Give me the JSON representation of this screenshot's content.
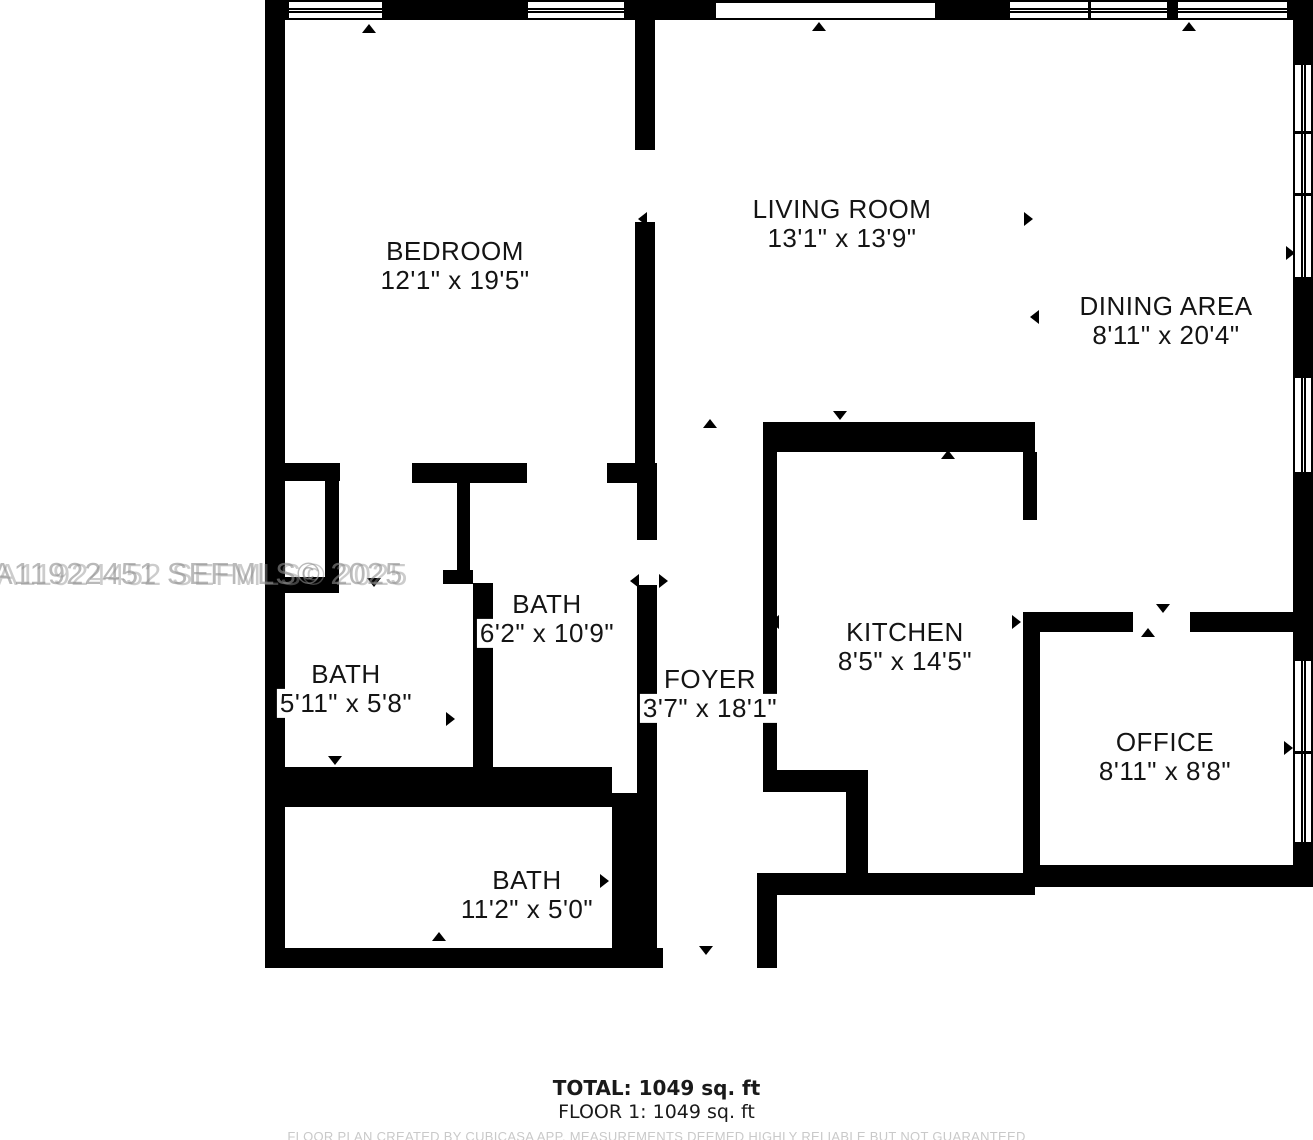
{
  "floor_plan": {
    "rooms": [
      {
        "id": "bedroom",
        "name": "BEDROOM",
        "dims": "12'1\" x 19'5\""
      },
      {
        "id": "living",
        "name": "LIVING ROOM",
        "dims": "13'1\" x 13'9\""
      },
      {
        "id": "dining",
        "name": "DINING AREA",
        "dims": "8'11\" x 20'4\""
      },
      {
        "id": "bath-mid",
        "name": "BATH",
        "dims": "6'2\" x 10'9\""
      },
      {
        "id": "bath-left",
        "name": "BATH",
        "dims": "5'11\" x 5'8\""
      },
      {
        "id": "foyer",
        "name": "FOYER",
        "dims": "3'7\" x 18'1\""
      },
      {
        "id": "kitchen",
        "name": "KITCHEN",
        "dims": "8'5\" x 14'5\""
      },
      {
        "id": "office",
        "name": "OFFICE",
        "dims": "8'11\" x 8'8\""
      },
      {
        "id": "bath-bottom",
        "name": "BATH",
        "dims": "11'2\" x 5'0\""
      }
    ],
    "watermark": {
      "line1": "A11922451 SEFMLS© 2025",
      "line2": "A11924452 SEFMLS© 2025"
    },
    "footer": {
      "total": "TOTAL: 1049 sq. ft",
      "floor": "FLOOR 1: 1049 sq. ft",
      "disclaimer": "FLOOR PLAN CREATED BY CUBICASA APP. MEASUREMENTS DEEMED HIGHLY RELIABLE BUT NOT GUARANTEED"
    },
    "colors": {
      "wall": "#000000",
      "background": "#ffffff",
      "watermark": "#8f8f8f",
      "disclaimer": "#c9c9c9"
    }
  }
}
